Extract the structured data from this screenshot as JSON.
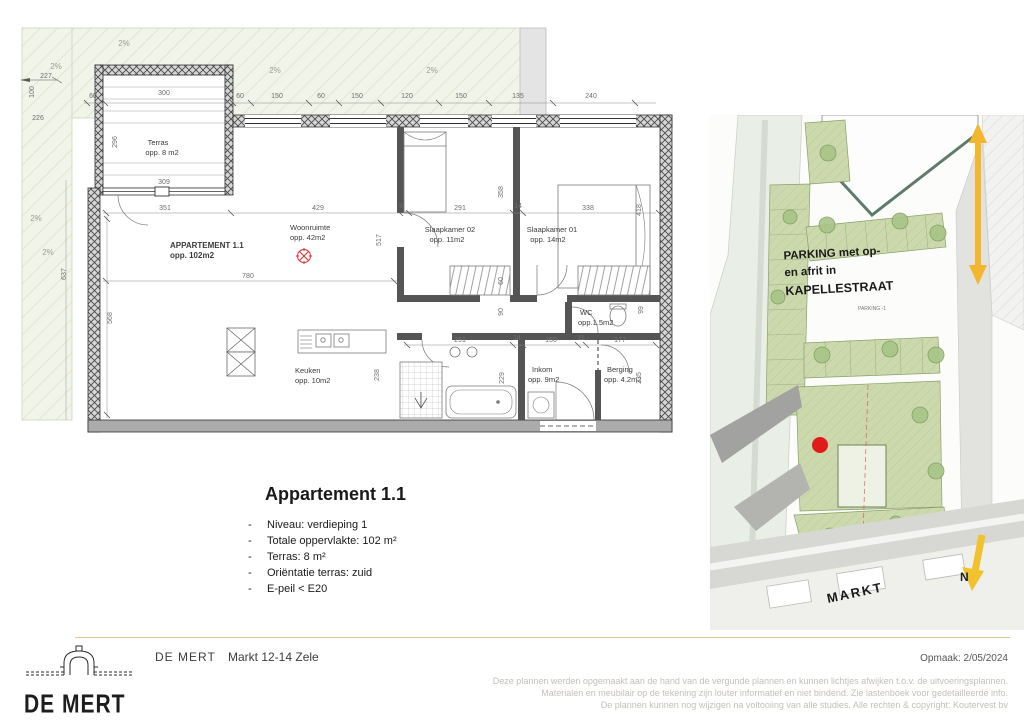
{
  "plan": {
    "apartment": {
      "name": "APPARTEMENT 1.1",
      "area": "opp. 102m2"
    },
    "rooms": {
      "terras": {
        "name": "Terras",
        "area": "opp. 8 m2"
      },
      "woonruimte": {
        "name": "Woonruimte",
        "area": "opp. 42m2"
      },
      "slaapkamer02": {
        "name": "Slaapkamer 02",
        "area": "opp. 11m2"
      },
      "slaapkamer01": {
        "name": "Slaapkamer 01",
        "area": "opp. 14m2"
      },
      "wc": {
        "name": "WC",
        "area": "opp.1.5m2"
      },
      "keuken": {
        "name": "Keuken",
        "area": "opp. 10m2"
      },
      "inkom": {
        "name": "Inkom",
        "area": "opp. 9m2"
      },
      "berging": {
        "name": "Berging",
        "area": "opp. 4.2m2"
      }
    },
    "dims": {
      "top_chain": [
        "60",
        "300",
        "60",
        "150",
        "60",
        "150",
        "120",
        "150",
        "135",
        "240"
      ],
      "inner_chain": [
        "351",
        "429",
        "9",
        "291",
        "14",
        "338"
      ],
      "bottom_chain": [
        "291",
        "14",
        "150",
        "11",
        "177"
      ],
      "h227": "227",
      "h226": "226",
      "h309": "309",
      "h780": "780",
      "v100": "100",
      "v296": "296",
      "v517": "517",
      "v358": "358",
      "v418": "418",
      "v568": "568",
      "v637": "637",
      "v229": "229",
      "v235": "235",
      "v238": "238",
      "v60": "60",
      "v90": "90",
      "v99": "99",
      "slope": "2%"
    }
  },
  "info": {
    "title": "Appartement 1.1",
    "bullet": "-",
    "items": [
      "Niveau: verdieping 1",
      "Totale oppervlakte: 102 m²",
      "Terras: 8 m²",
      "Oriëntatie terras: zuid",
      "E-peil < E20"
    ]
  },
  "situering": {
    "title": "SITUERING",
    "parking_line1": "PARKING met op-",
    "parking_line2": "en afrit in",
    "parking_line3": "KAPELLESTRAAT",
    "parking_small": "PARKING -1",
    "street": "MARKT",
    "north": "N"
  },
  "footer": {
    "logo_text": "DE MERT",
    "brand": "DE MERT",
    "address": "Markt 12-14 Zele",
    "date": "Opmaak: 2/05/2024",
    "disclaimer": [
      "Deze plannen werden opgemaakt aan de hand van de vergunde plannen en kunnen lichtjes afwijken t.o.v. de uitvoeringsplannen.",
      "Materialen en meubilair op de tekening zijn louter informatief en niet bindend. Zie lastenboek voor gedetailleerde info.",
      "De plannen kunnen nog wijzigen na voltooiing van alle studies. Alle rechten & copyright: Koutervest bv"
    ]
  },
  "colors": {
    "accent_red": "#e02020",
    "arrow_yellow": "#f2b72e",
    "divider_tan": "#d9c88f",
    "parcel_green": "#cfdcb2"
  }
}
